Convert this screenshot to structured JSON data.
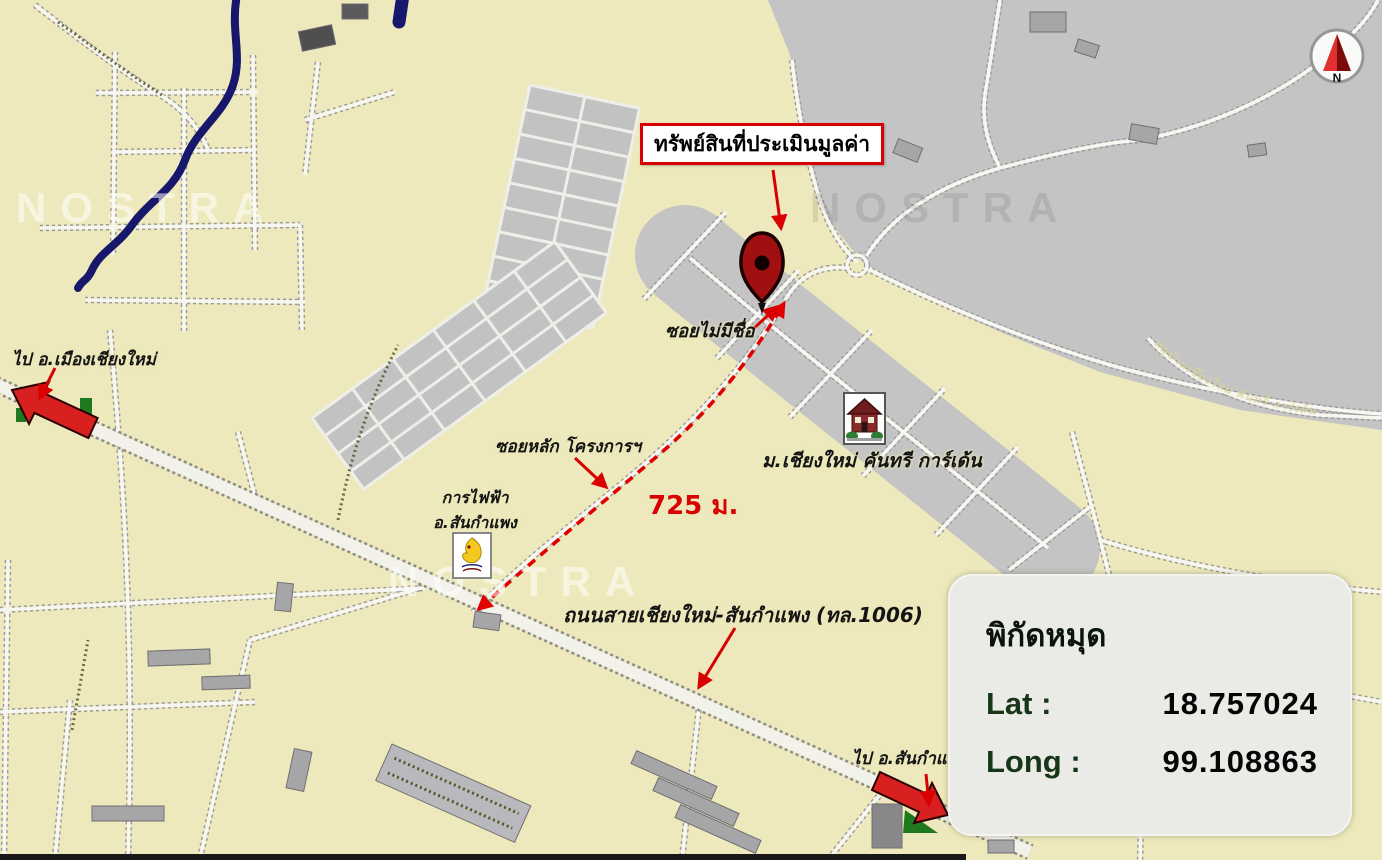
{
  "map": {
    "provider_watermark": "NOSTRA",
    "callout": {
      "property_label": "ทรัพย์สินที่ประเมินมูลค่า"
    },
    "labels": {
      "unnamed_soi": "ซอยไม่มีชื่อ",
      "village": "ม.เชียงใหม่ คันทรี การ์เด้น",
      "project_main_soi": "ซอยหลัก โครงการฯ",
      "distance": "725 ม.",
      "electricity_office_line1": "การไฟฟ้า",
      "electricity_office_line2": "อ.สันกำแพง",
      "highway": "ถนนสายเชียงใหม่-สันกำแพง (ทล.1006)",
      "to_mueang_chiang_mai": "ไป อ.เมืองเชียงใหม่",
      "to_san_kamphaeng": "ไป อ.สันกำแพง",
      "village_road_text": "หมู่บ้านเชียงใหม่ คันทรี การ์เด้น"
    },
    "compass": {
      "north_label": "N"
    },
    "coordinates_panel": {
      "title": "พิกัดหมุด",
      "lat_label": "Lat :",
      "lat_value": "18.757024",
      "long_label": "Long :",
      "long_value": "99.108863"
    },
    "colors": {
      "map_background": "#EDE9BC",
      "urban_area_gray": "#C4C4C4",
      "annotation_red": "#D80000",
      "river_navy": "#17176B",
      "route_red": "#E00000"
    }
  }
}
